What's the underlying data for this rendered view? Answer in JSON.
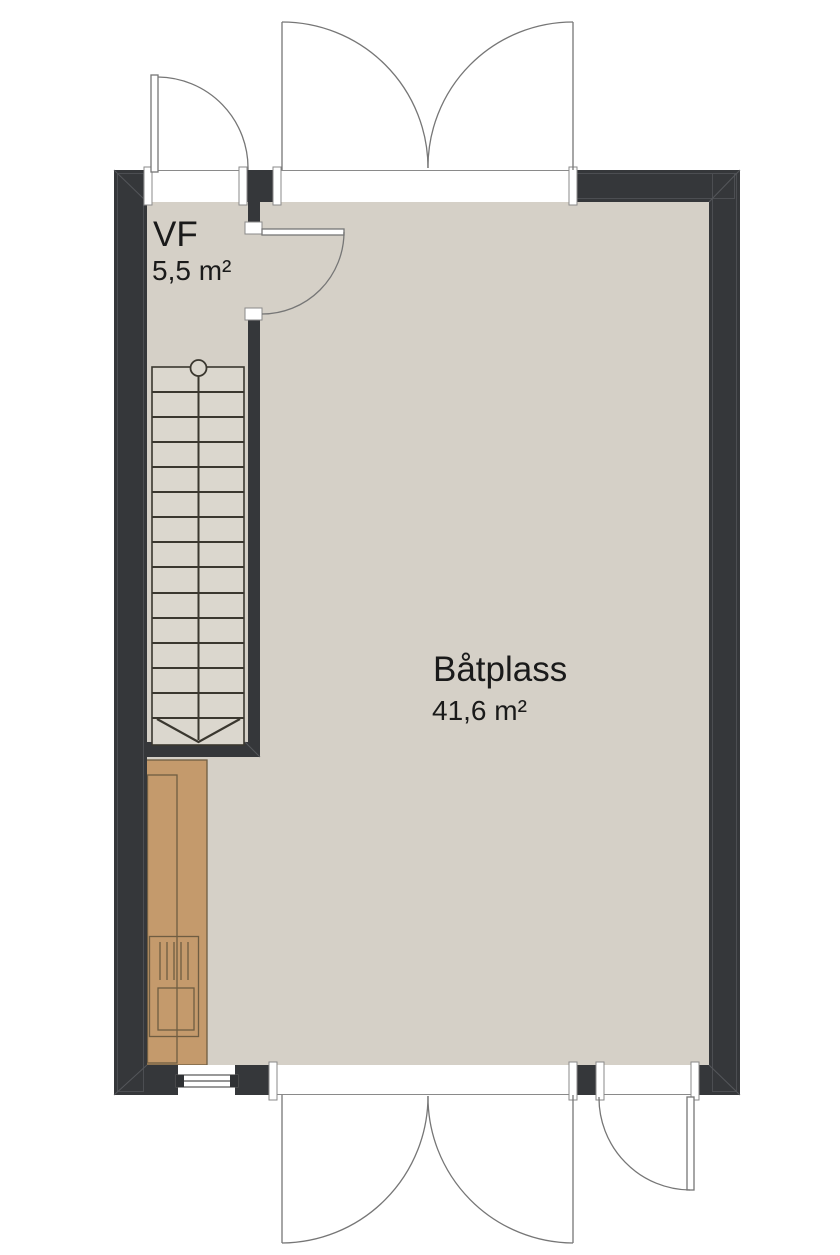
{
  "plan": {
    "type": "floor-plan",
    "rooms": [
      {
        "name": "VF",
        "area": "5,5 m²"
      },
      {
        "name": "Båtplass",
        "area": "41,6 m²"
      }
    ],
    "symbols": [
      "staircase-with-down-arrow",
      "newel-post-circle",
      "window",
      "door-swings",
      "kitchen-counter"
    ],
    "colors": {
      "background": "#ffffff",
      "wall": "#35373a",
      "wall_face_line": "#4c4e52",
      "floor": "#d5d0c7",
      "stair_floor": "#dbd7ce",
      "stair_line": "#3a372f",
      "counter": "#c49a6c",
      "counter_line": "#6f5d42",
      "door_line": "#767676",
      "text": "#1a1a1a"
    }
  }
}
